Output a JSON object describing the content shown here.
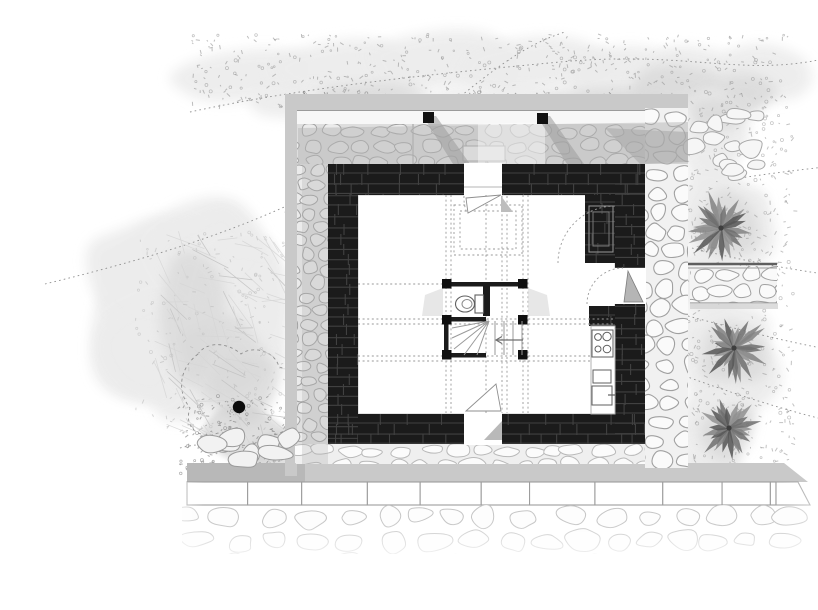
{
  "drawing": {
    "kind": "architectural ground-floor plan: stone house with walled courtyard, garden and palm trees",
    "features": [
      {
        "name": "house-black-masonry-walls"
      },
      {
        "name": "entry-door-top"
      },
      {
        "name": "entry-door-bottom"
      },
      {
        "name": "side-door-right"
      },
      {
        "name": "fireplace-niche"
      },
      {
        "name": "stair-core"
      },
      {
        "name": "winder-staircase"
      },
      {
        "name": "wc-toilet"
      },
      {
        "name": "kitchen-counter"
      },
      {
        "name": "cooktop"
      },
      {
        "name": "kitchen-sink"
      },
      {
        "name": "courtyard-stone-paving"
      },
      {
        "name": "perimeter-enclosure-wall"
      },
      {
        "name": "courtyard-posts"
      },
      {
        "name": "palm-trees"
      },
      {
        "name": "garden-tree"
      },
      {
        "name": "tree-trunk-marker"
      },
      {
        "name": "stone-wall-band-right"
      },
      {
        "name": "paver-walkway-bottom"
      },
      {
        "name": "rubble-stone-field-bottom"
      },
      {
        "name": "dotted-contour-lines"
      },
      {
        "name": "upper-floor-dashed-projections"
      }
    ]
  },
  "counts": {
    "palm_trees": 3,
    "courtyard_posts": 2,
    "stair_treads": 4,
    "cooktop_burners": 4,
    "door_openings": 3
  },
  "palette": {
    "paper": "#ffffff",
    "wall_black": "#1b1b1b",
    "wall_joint": "#414141",
    "stone_outline": "#a0a0a0",
    "stone_outline_light": "#c6c6c6",
    "stone_fill": "#ebebeb",
    "stone_fill_light": "#fafafa",
    "courtyard_bg": "#dedede",
    "enclosure_band": "#c9c9c9",
    "shadow": "#b5b5b5",
    "dash_line": "#9a9a9a",
    "dotted_contour": "#8f8f8f",
    "watercolor": "#ececec",
    "watercolor_dark": "#d9d9d9",
    "speckle": "#9b9b9b",
    "palm_frond": "#6e6e6e",
    "fixture_line": "#5f5f5f",
    "trunk_dot": "#0b0b0b"
  },
  "texture": {
    "seed": 12
  }
}
